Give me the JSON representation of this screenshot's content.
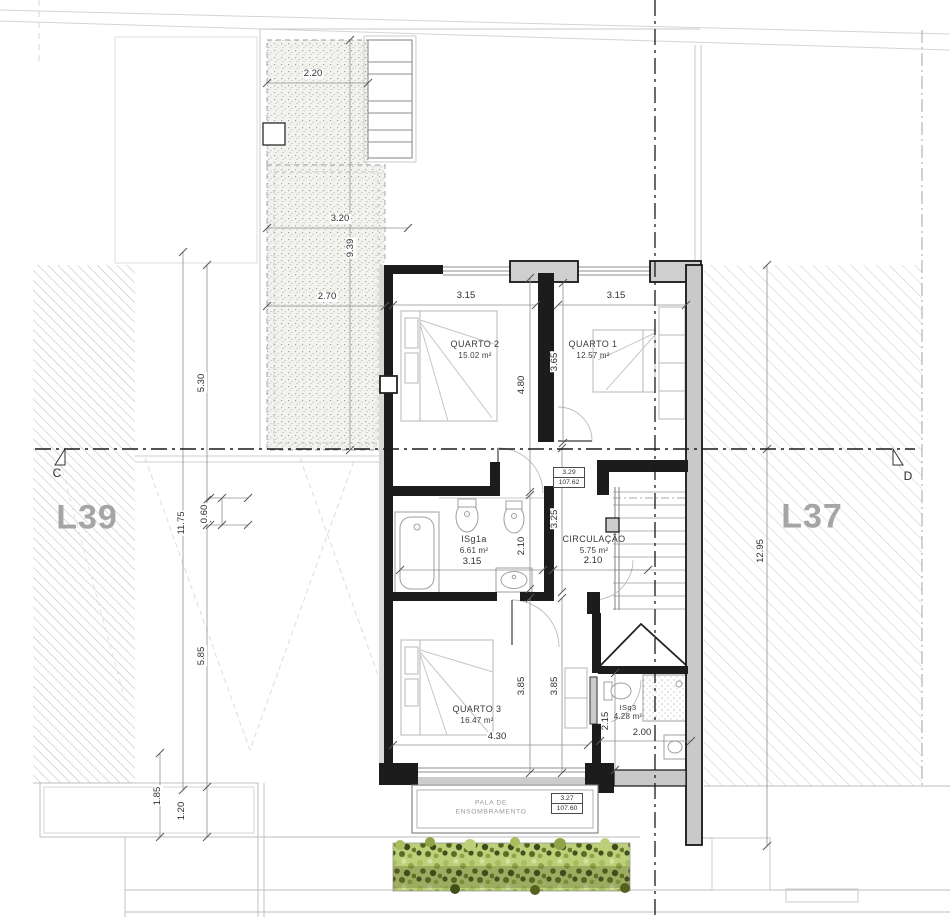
{
  "drawing": {
    "type": "architectural floor plan - upper floor",
    "section_line_left": "C",
    "section_line_right": "D"
  },
  "lots": {
    "left": "L39",
    "right": "L37"
  },
  "rooms": {
    "quarto2": {
      "name": "QUARTO 2",
      "area": "15.02 m²"
    },
    "quarto1": {
      "name": "QUARTO 1",
      "area": "12.57 m²"
    },
    "isg1a": {
      "name": "ISg1a",
      "area": "6.61 m²"
    },
    "circulacao": {
      "name": "CIRCULAÇÃO",
      "area": "5.75 m²"
    },
    "quarto3": {
      "name": "QUARTO 3",
      "area": "16.47 m²"
    },
    "isq3": {
      "name": "ISq3",
      "area": "4.28 m²"
    }
  },
  "canopy": {
    "line1": "PALA DE",
    "line2": "ENSOMBRAMENTO"
  },
  "levels": {
    "upper": {
      "height": "3.29",
      "elevation": "107.62"
    },
    "lower": {
      "height": "3.27",
      "elevation": "107.60"
    }
  },
  "dims": [
    {
      "label": "2.20",
      "x": 313,
      "y": 74,
      "v": 0
    },
    {
      "label": "3.20",
      "x": 340,
      "y": 219,
      "v": 0
    },
    {
      "label": "2.70",
      "x": 327,
      "y": 297,
      "v": 0
    },
    {
      "label": "9.39",
      "x": 351,
      "y": 248,
      "v": 1
    },
    {
      "label": "3.15",
      "x": 466,
      "y": 296,
      "v": 0
    },
    {
      "label": "3.15",
      "x": 616,
      "y": 296,
      "v": 0
    },
    {
      "label": "4.80",
      "x": 522,
      "y": 385,
      "v": 1
    },
    {
      "label": "3.65",
      "x": 555,
      "y": 362,
      "v": 1
    },
    {
      "label": "3.15",
      "x": 472,
      "y": 562,
      "v": 0
    },
    {
      "label": "2.10",
      "x": 522,
      "y": 546,
      "v": 1
    },
    {
      "label": "2.10",
      "x": 593,
      "y": 561,
      "v": 0
    },
    {
      "label": "3.25",
      "x": 555,
      "y": 519,
      "v": 1
    },
    {
      "label": "4.30",
      "x": 497,
      "y": 737,
      "v": 0
    },
    {
      "label": "3.85",
      "x": 522,
      "y": 686,
      "v": 1
    },
    {
      "label": "3.85",
      "x": 555,
      "y": 686,
      "v": 1
    },
    {
      "label": "2.15",
      "x": 606,
      "y": 721,
      "v": 1
    },
    {
      "label": "2.00",
      "x": 642,
      "y": 733,
      "v": 0
    },
    {
      "label": "5.30",
      "x": 202,
      "y": 383,
      "v": 1
    },
    {
      "label": "11.75",
      "x": 182,
      "y": 523,
      "v": 1
    },
    {
      "label": "0.60",
      "x": 205,
      "y": 514,
      "v": 1
    },
    {
      "label": "5.85",
      "x": 202,
      "y": 656,
      "v": 1
    },
    {
      "label": "1.85",
      "x": 158,
      "y": 796,
      "v": 1
    },
    {
      "label": "1.20",
      "x": 182,
      "y": 811,
      "v": 1
    },
    {
      "label": "12.95",
      "x": 761,
      "y": 551,
      "v": 1
    }
  ],
  "colors": {
    "wall": "#1c1c1c",
    "party_wall_fill": "#c9c9c9",
    "hatch_line": "#c4c4c4",
    "lot_label": "#a5a5a5",
    "hedge_light": "#bccf79",
    "hedge_dark": "#4a5420"
  }
}
